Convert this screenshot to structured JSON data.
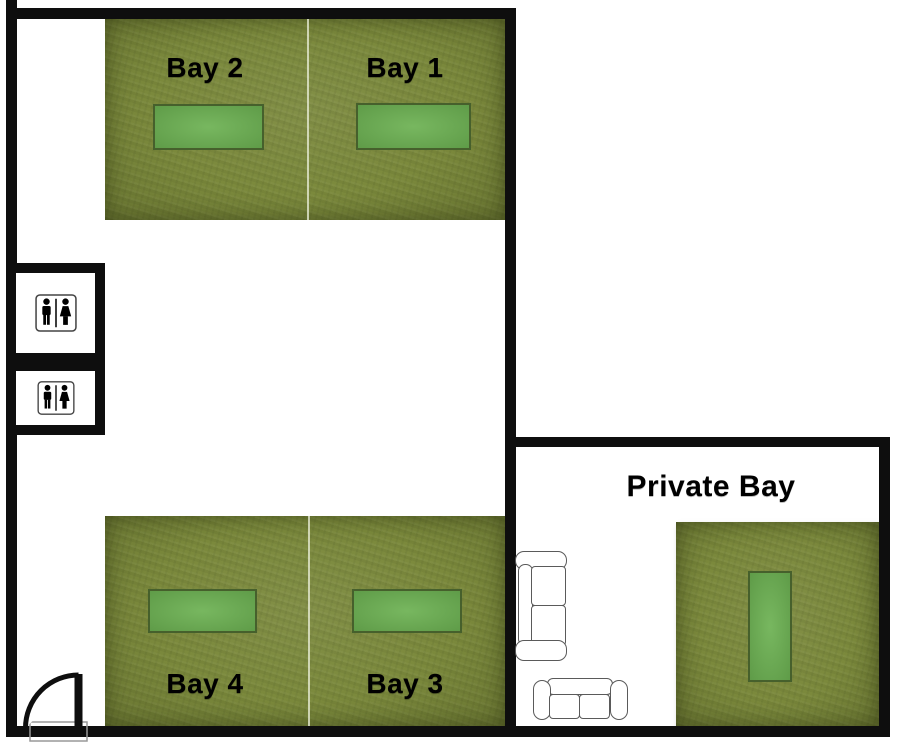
{
  "title": "Golf Simulator Facility Floor Plan",
  "colors": {
    "wall": "#0e0e0e",
    "turf": "#7b893c",
    "mat": "#6cb152",
    "mat_border": "#46602c",
    "label_text": "#000000",
    "background": "#ffffff",
    "couch_outline": "#5a5a5a",
    "bay_divider": "#ecf0dc"
  },
  "rooms": {
    "bay2": {
      "label": "Bay 2"
    },
    "bay1": {
      "label": "Bay 1"
    },
    "bay4": {
      "label": "Bay 4"
    },
    "bay3": {
      "label": "Bay 3"
    },
    "private": {
      "label": "Private Bay"
    }
  },
  "fixtures": {
    "restrooms": [
      {
        "name": "restroom-upper",
        "icon": "male-female-restroom-icon"
      },
      {
        "name": "restroom-lower",
        "icon": "male-female-restroom-icon"
      }
    ],
    "couches": [
      {
        "name": "couch-vertical",
        "seats": 2
      },
      {
        "name": "couch-horizontal",
        "seats": 2
      }
    ],
    "door": {
      "name": "entrance-door",
      "type": "swing"
    },
    "hitting_mats": 5
  }
}
